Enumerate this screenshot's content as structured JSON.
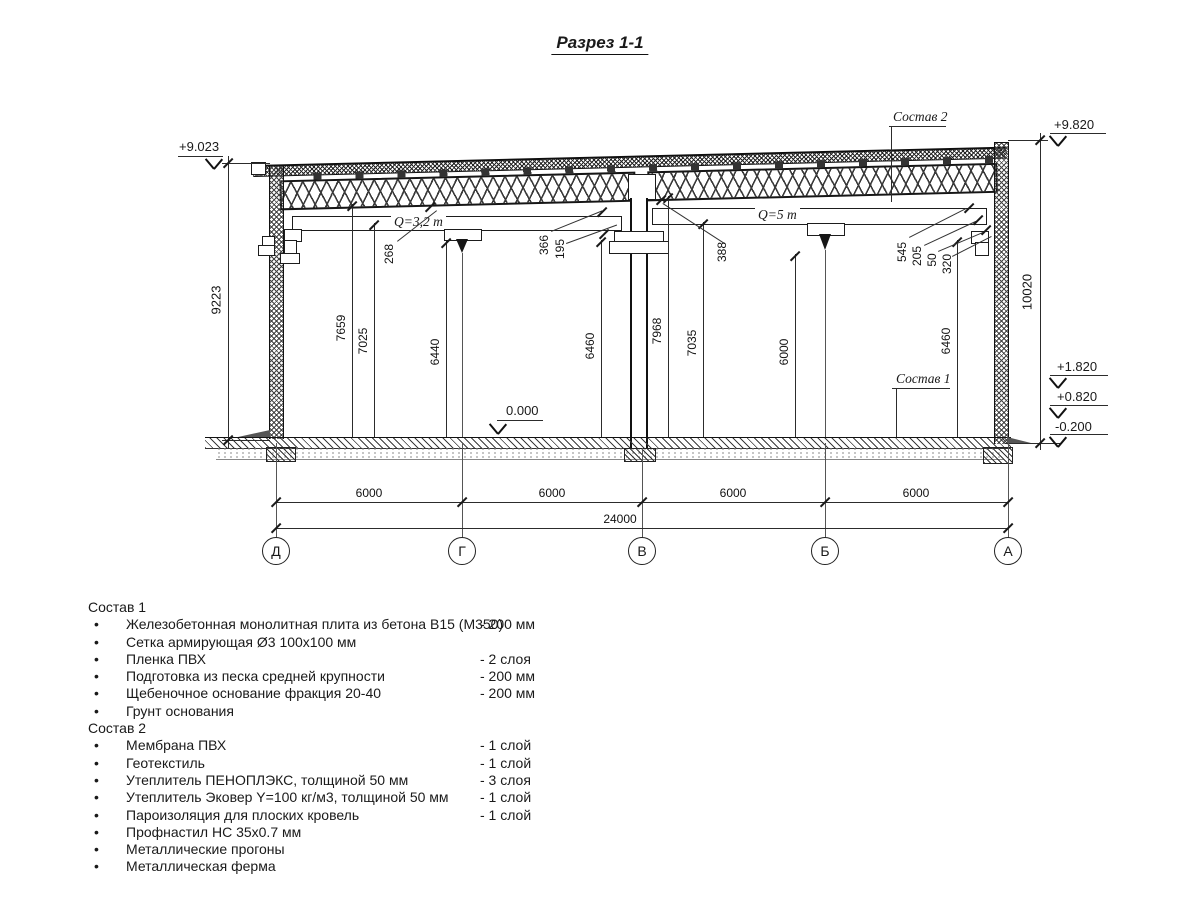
{
  "title": "Разрез 1-1",
  "bullet": "•",
  "callouts": {
    "sostav1": "Состав 1",
    "sostav2": "Состав 2"
  },
  "cranes": {
    "left": "Q=3,2 т",
    "right": "Q=5 т"
  },
  "elevations": {
    "top_left": "+9.023",
    "top_right": "+9.820",
    "mid_high": "+1.820",
    "mid_low": "+0.820",
    "ground": "-0.200",
    "zero": "0.000"
  },
  "dims": {
    "left_outer": "9223",
    "right_outer": "10020",
    "span": "6000",
    "total": "24000",
    "v1": "7659",
    "v2": "7025",
    "v3": "6440",
    "v4": "6460",
    "v5": "7968",
    "v6": "7035",
    "v7": "6000",
    "v8": "6460",
    "s1": "268",
    "s2": "366",
    "s3": "195",
    "s4": "388",
    "s5": "545",
    "s6": "205",
    "s7": "50",
    "s8": "320"
  },
  "axes": [
    "Д",
    "Г",
    "В",
    "Б",
    "А"
  ],
  "lists": {
    "sostav1": {
      "heading": "Состав 1",
      "items": [
        {
          "name": "Железобетонная монолитная плита из бетона В15 (М350)",
          "value": "-  200 мм"
        },
        {
          "name": "Сетка армирующая Ø3 100х100 мм",
          "value": ""
        },
        {
          "name": "Пленка ПВХ",
          "value": "-  2 слоя"
        },
        {
          "name": "Подготовка из песка средней крупности",
          "value": "- 200 мм"
        },
        {
          "name": "Щебеночное основание фракция 20-40",
          "value": "- 200 мм"
        },
        {
          "name": "Грунт основания",
          "value": ""
        }
      ]
    },
    "sostav2": {
      "heading": "Состав 2",
      "items": [
        {
          "name": "Мембрана ПВХ",
          "value": "- 1 слой"
        },
        {
          "name": "Геотекстиль",
          "value": "- 1 слой"
        },
        {
          "name": "Утеплитель ПЕНОПЛЭКС, толщиной 50 мм",
          "value": "- 3 слоя"
        },
        {
          "name": "Утеплитель Эковер Y=100 кг/м3, толщиной 50 мм",
          "value": "- 1 слой"
        },
        {
          "name": "Пароизоляция для плоских кровель",
          "value": "- 1 слой"
        },
        {
          "name": "Профнастил НС 35х0.7 мм",
          "value": ""
        },
        {
          "name": "Металлические прогоны",
          "value": ""
        },
        {
          "name": "Металлическая ферма",
          "value": ""
        }
      ]
    }
  }
}
